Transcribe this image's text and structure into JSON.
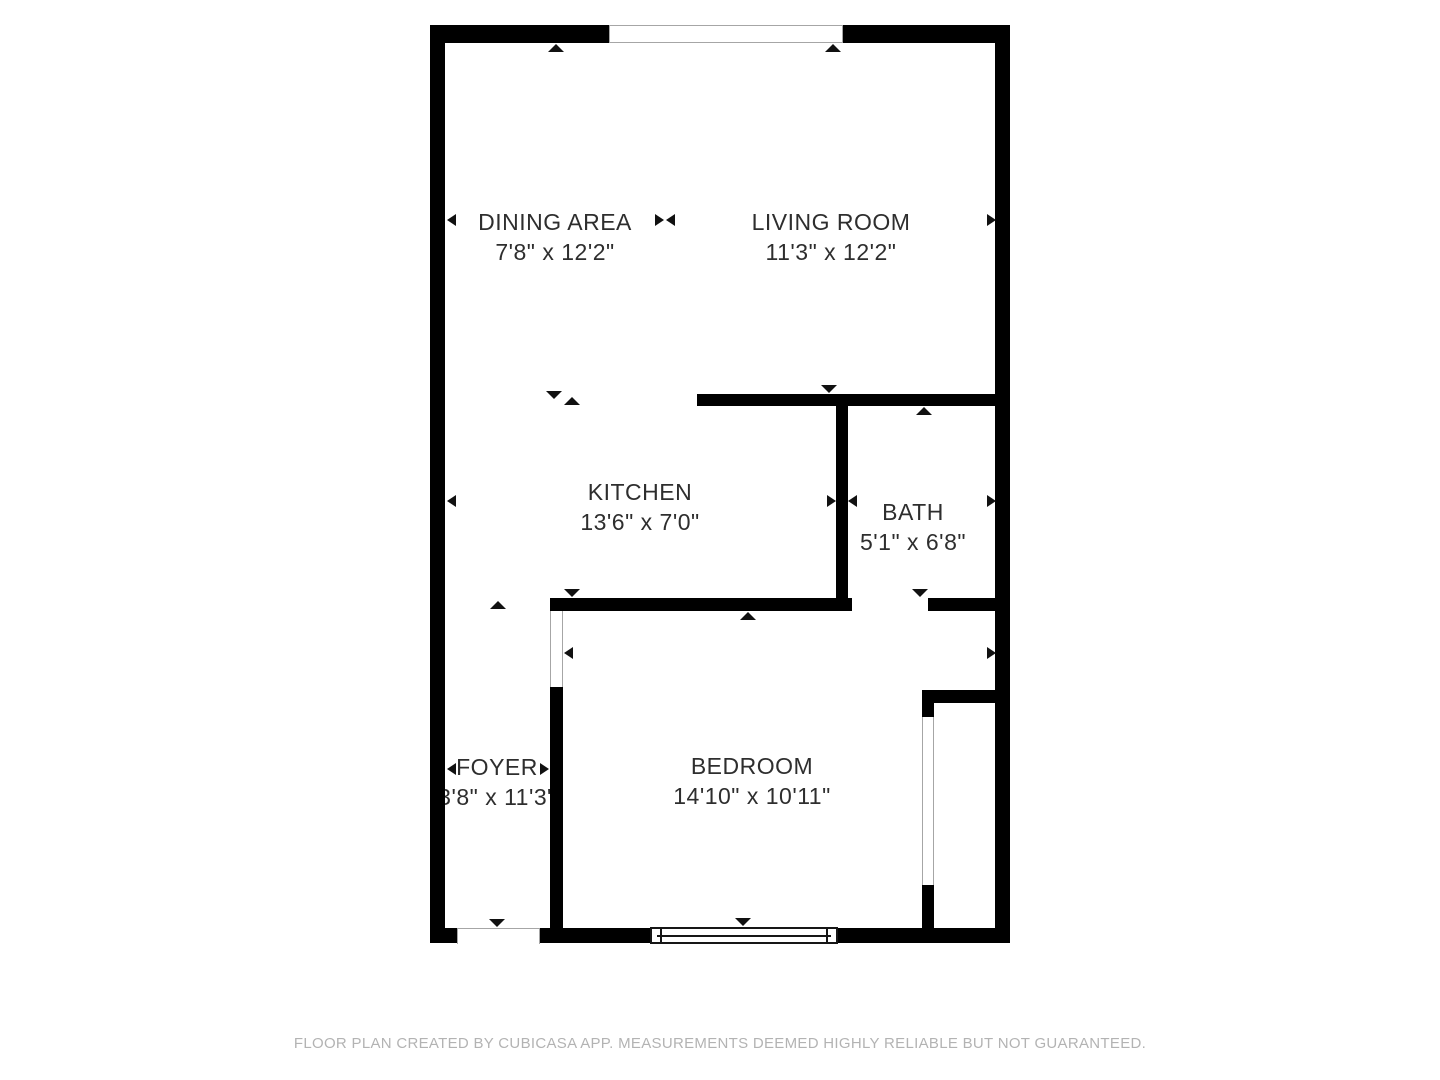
{
  "floorplan": {
    "rooms": [
      {
        "name": "DINING AREA",
        "dimensions": "7'8\" x 12'2\""
      },
      {
        "name": "LIVING ROOM",
        "dimensions": "11'3\" x 12'2\""
      },
      {
        "name": "KITCHEN",
        "dimensions": "13'6\" x 7'0\""
      },
      {
        "name": "BATH",
        "dimensions": "5'1\" x 6'8\""
      },
      {
        "name": "FOYER",
        "dimensions": "3'8\" x 11'3\""
      },
      {
        "name": "BEDROOM",
        "dimensions": "14'10\" x 10'11\""
      }
    ]
  },
  "footer": {
    "disclaimer": "FLOOR PLAN CREATED BY CUBICASA APP. MEASUREMENTS DEEMED HIGHLY RELIABLE BUT NOT GUARANTEED."
  },
  "colors": {
    "wall": "#000000",
    "label_text": "#2e2e2e",
    "footer_text": "#b3b3b3",
    "opening_outline": "#a6a6a6",
    "background": "#ffffff"
  }
}
